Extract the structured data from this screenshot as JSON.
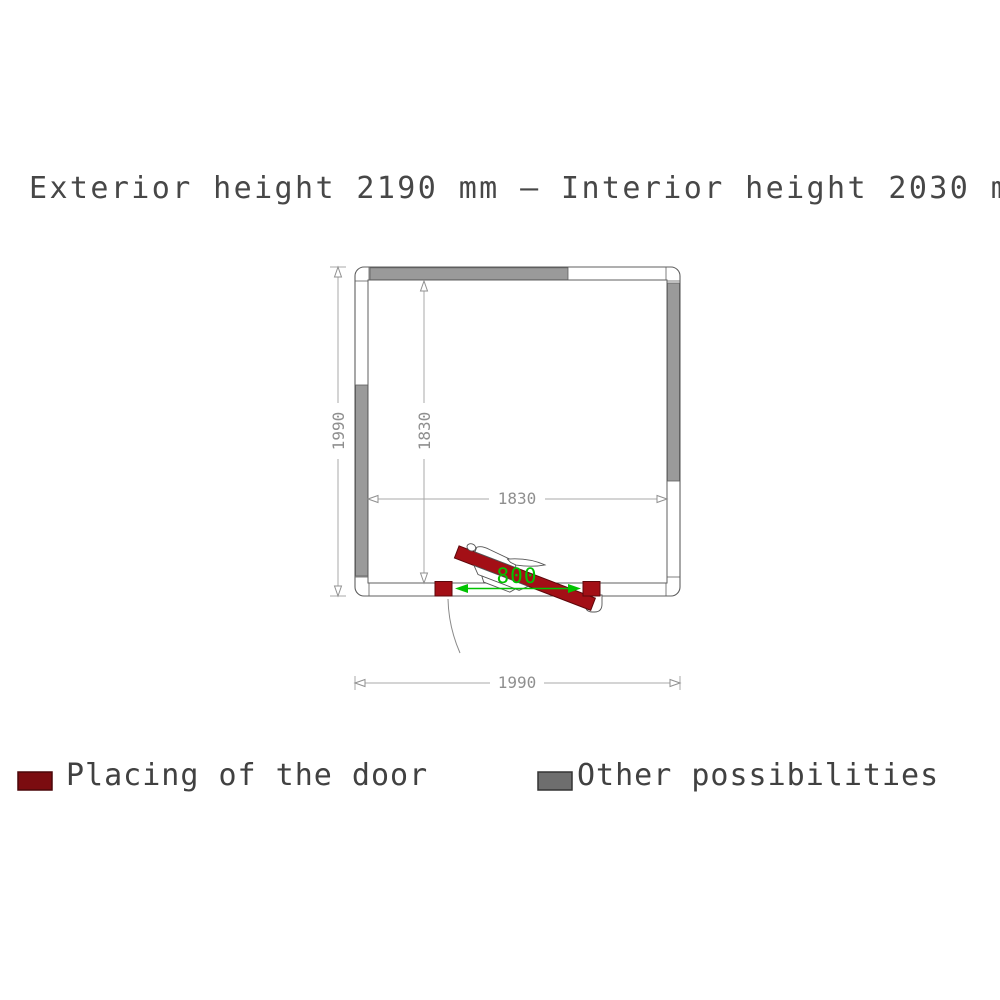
{
  "title": "Exterior height 2190 mm – Interior height 2030 mm",
  "plan": {
    "dimensions": {
      "exterior_vertical": "1990",
      "exterior_horizontal": "1990",
      "interior_vertical": "1830",
      "interior_horizontal": "1830",
      "door_opening": "800"
    }
  },
  "legend": {
    "door": {
      "label": "Placing of the door"
    },
    "other": {
      "label": "Other possibilities"
    }
  },
  "colors": {
    "door_red": "#a30f16",
    "door_red_dark": "#5c070b",
    "legend_red": "#7b0c10",
    "wall_gray": "#9a9a9a",
    "legend_gray": "#6e6e6e",
    "outline_gray": "#5f5f5f",
    "dim_line_gray": "#a8a8a8",
    "dim_text_gray": "#8f8f8f",
    "door_dim_green": "#00c300",
    "title_text": "#474747"
  }
}
